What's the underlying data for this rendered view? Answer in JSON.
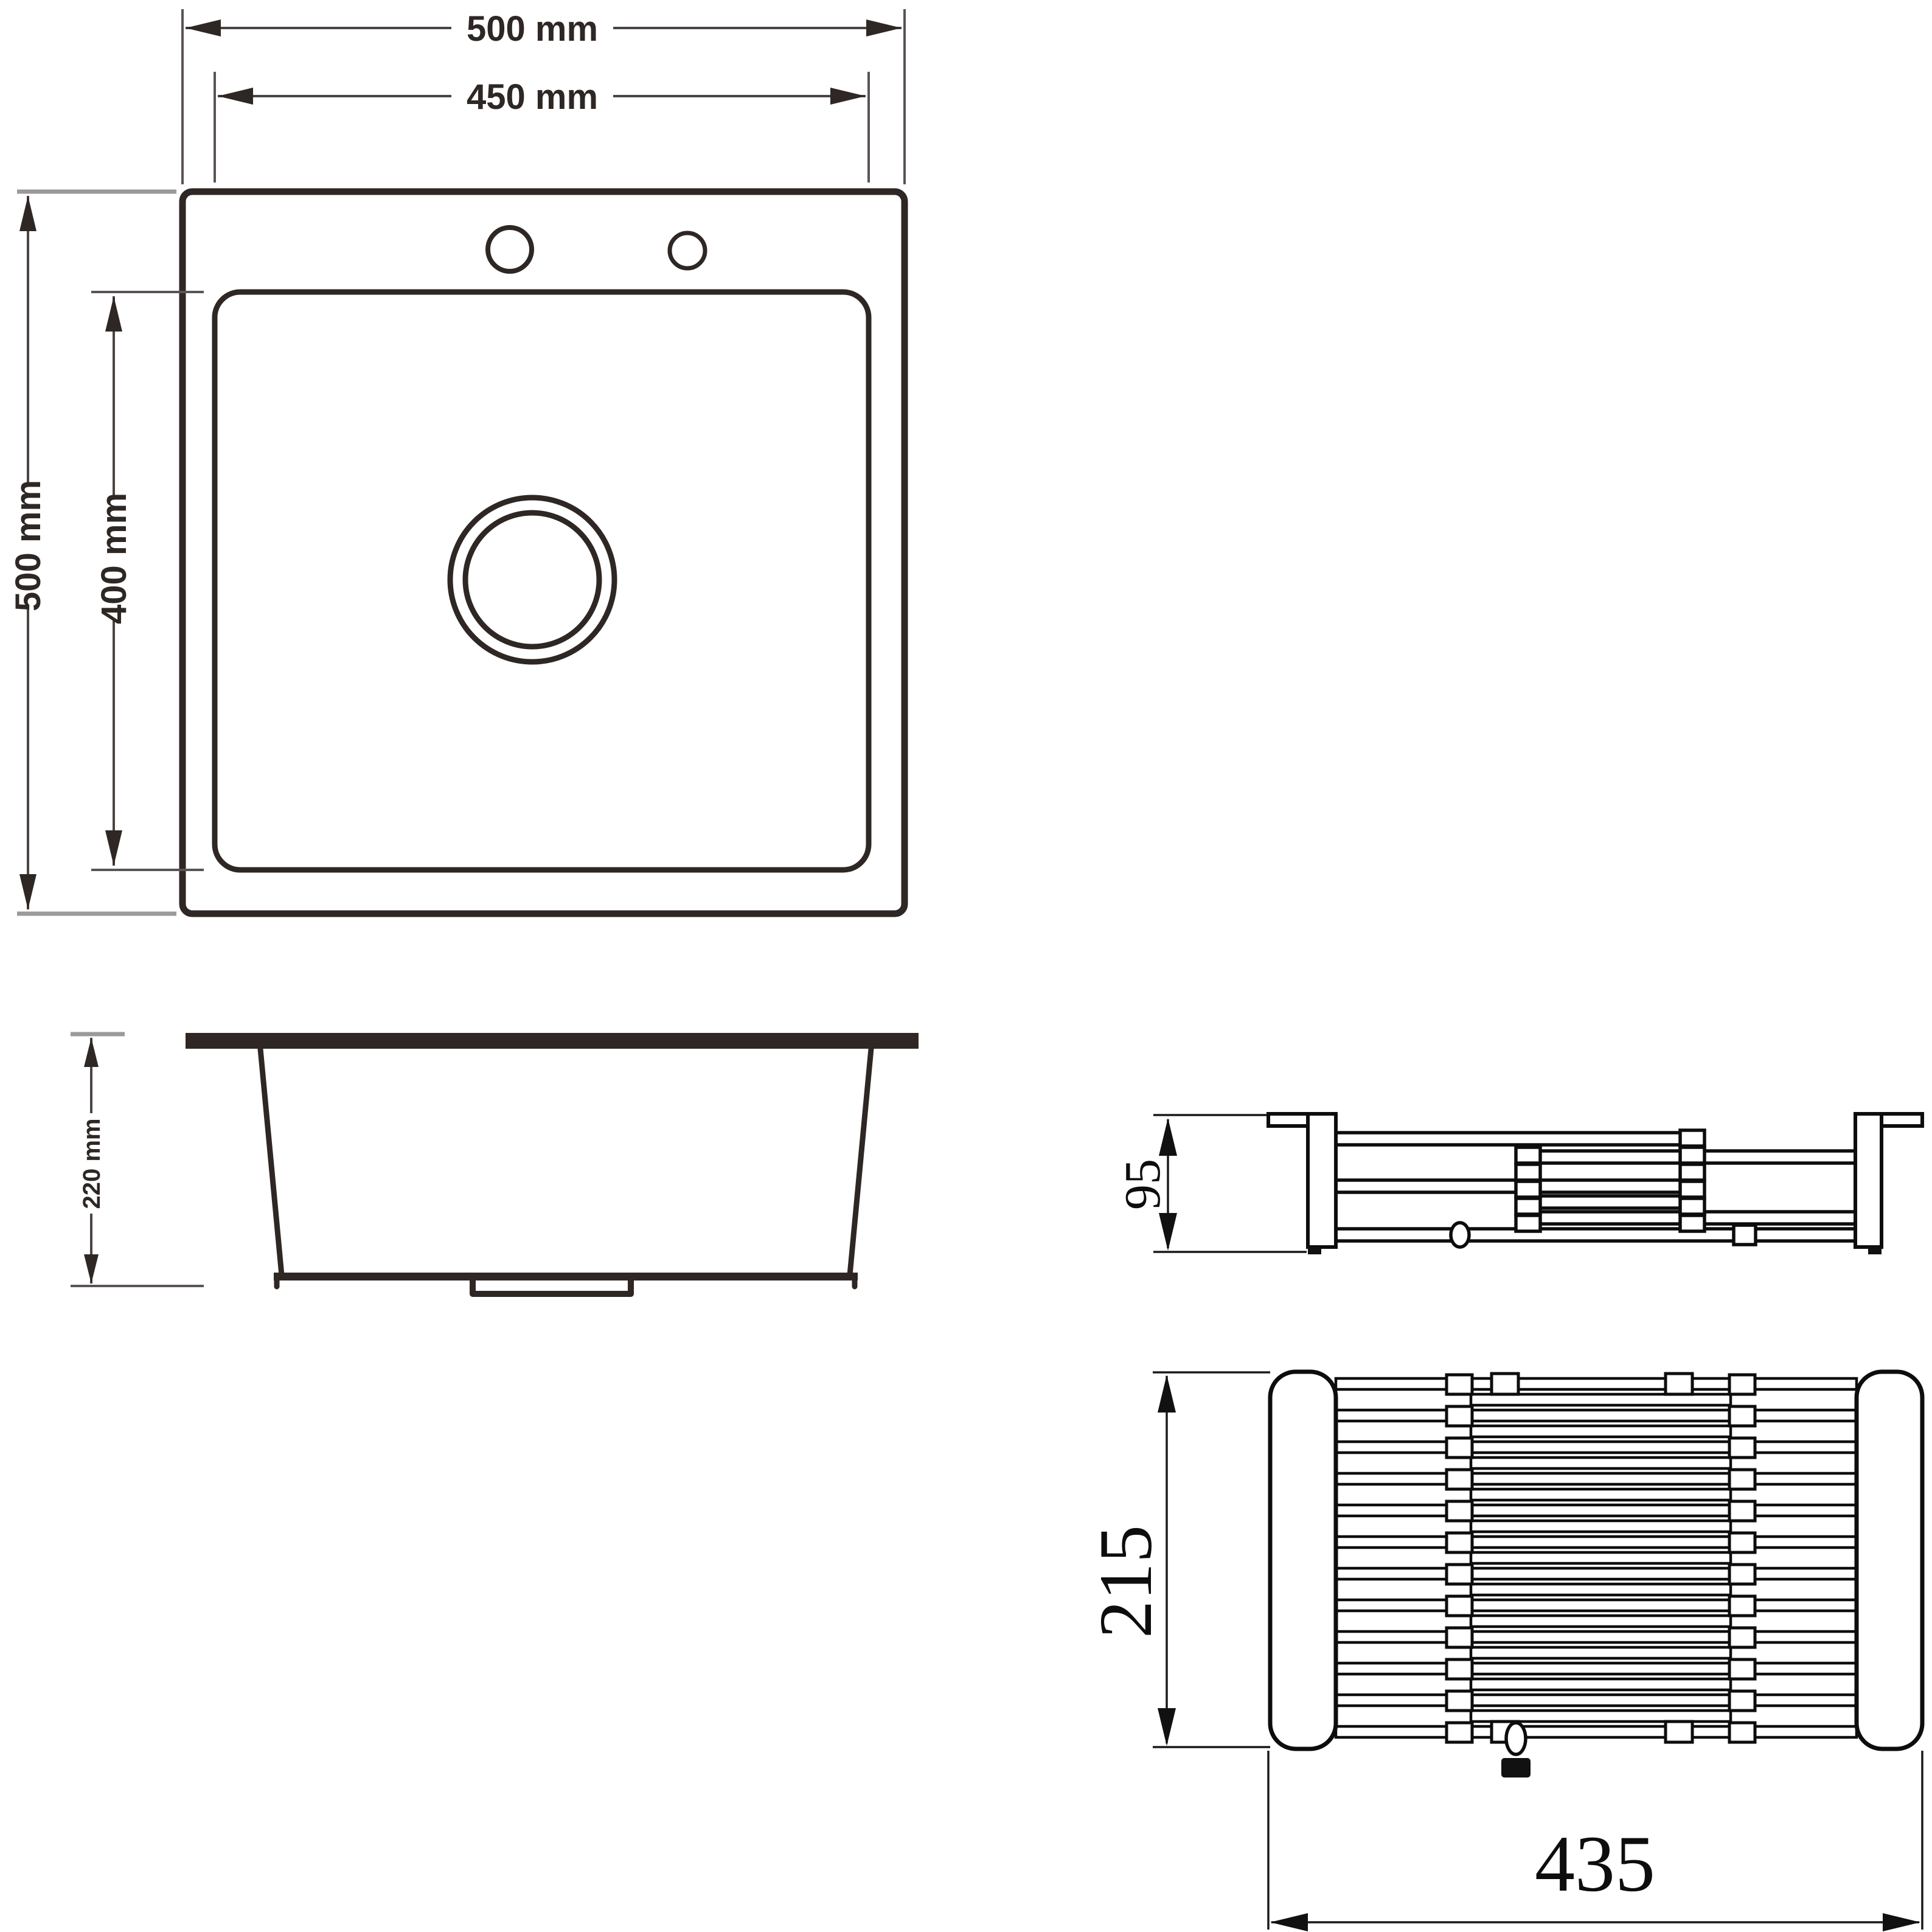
{
  "drawing": {
    "sink_top_view": {
      "dim_outer_width": "500 mm",
      "dim_inner_width": "450 mm",
      "dim_outer_height": "500 mm",
      "dim_inner_height": "400 mm"
    },
    "sink_side_view": {
      "dim_depth": "220 mm"
    },
    "basket_side_view": {
      "dim_height": "95"
    },
    "basket_top_view": {
      "dim_length": "215",
      "dim_width": "435"
    },
    "colors": {
      "sink_line": "#2e2724",
      "rack_line": "#0d0d0d",
      "extension_gray": "#9a9a9a",
      "background": "#ffffff"
    }
  }
}
